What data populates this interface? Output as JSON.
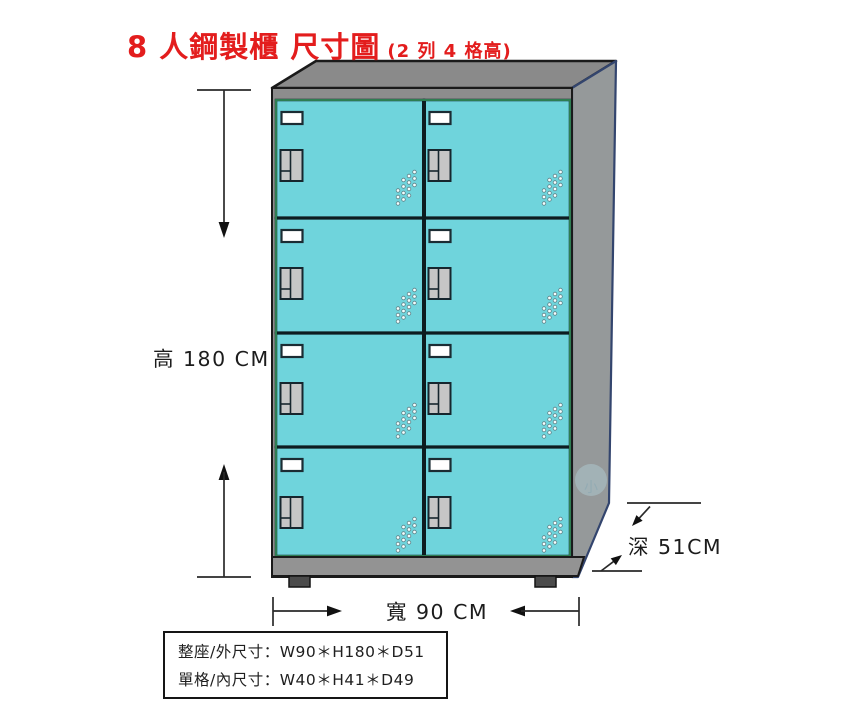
{
  "title": {
    "main": "8 人鋼製櫃 尺寸圖",
    "sub": "(2 列 4 格高)"
  },
  "dimensions": {
    "height_label": "高 180 CM",
    "width_label": "寬 90 CM",
    "depth_label": "深 51CM"
  },
  "spec_box": {
    "line1": "整座/外尺寸：W90＊H180＊D51",
    "line2": "單格/內尺寸：W40＊H41＊D49"
  },
  "cabinet": {
    "columns": 2,
    "rows": 4,
    "door_count": 8
  },
  "watermark_text": "小",
  "colors": {
    "title_red": "#e31d1d",
    "door_teal": "#6fd4dc",
    "slab_gray": "#8a8a8a",
    "side_gray": "#95999a",
    "frame_gray": "#8d8d8d",
    "base_gray": "#939393",
    "foot_gray": "#4b4b4b",
    "door_outline": "#13262b",
    "navy_edge": "#33456e",
    "green_edge": "#2e7d52",
    "dim_line": "#2a2a2a"
  }
}
